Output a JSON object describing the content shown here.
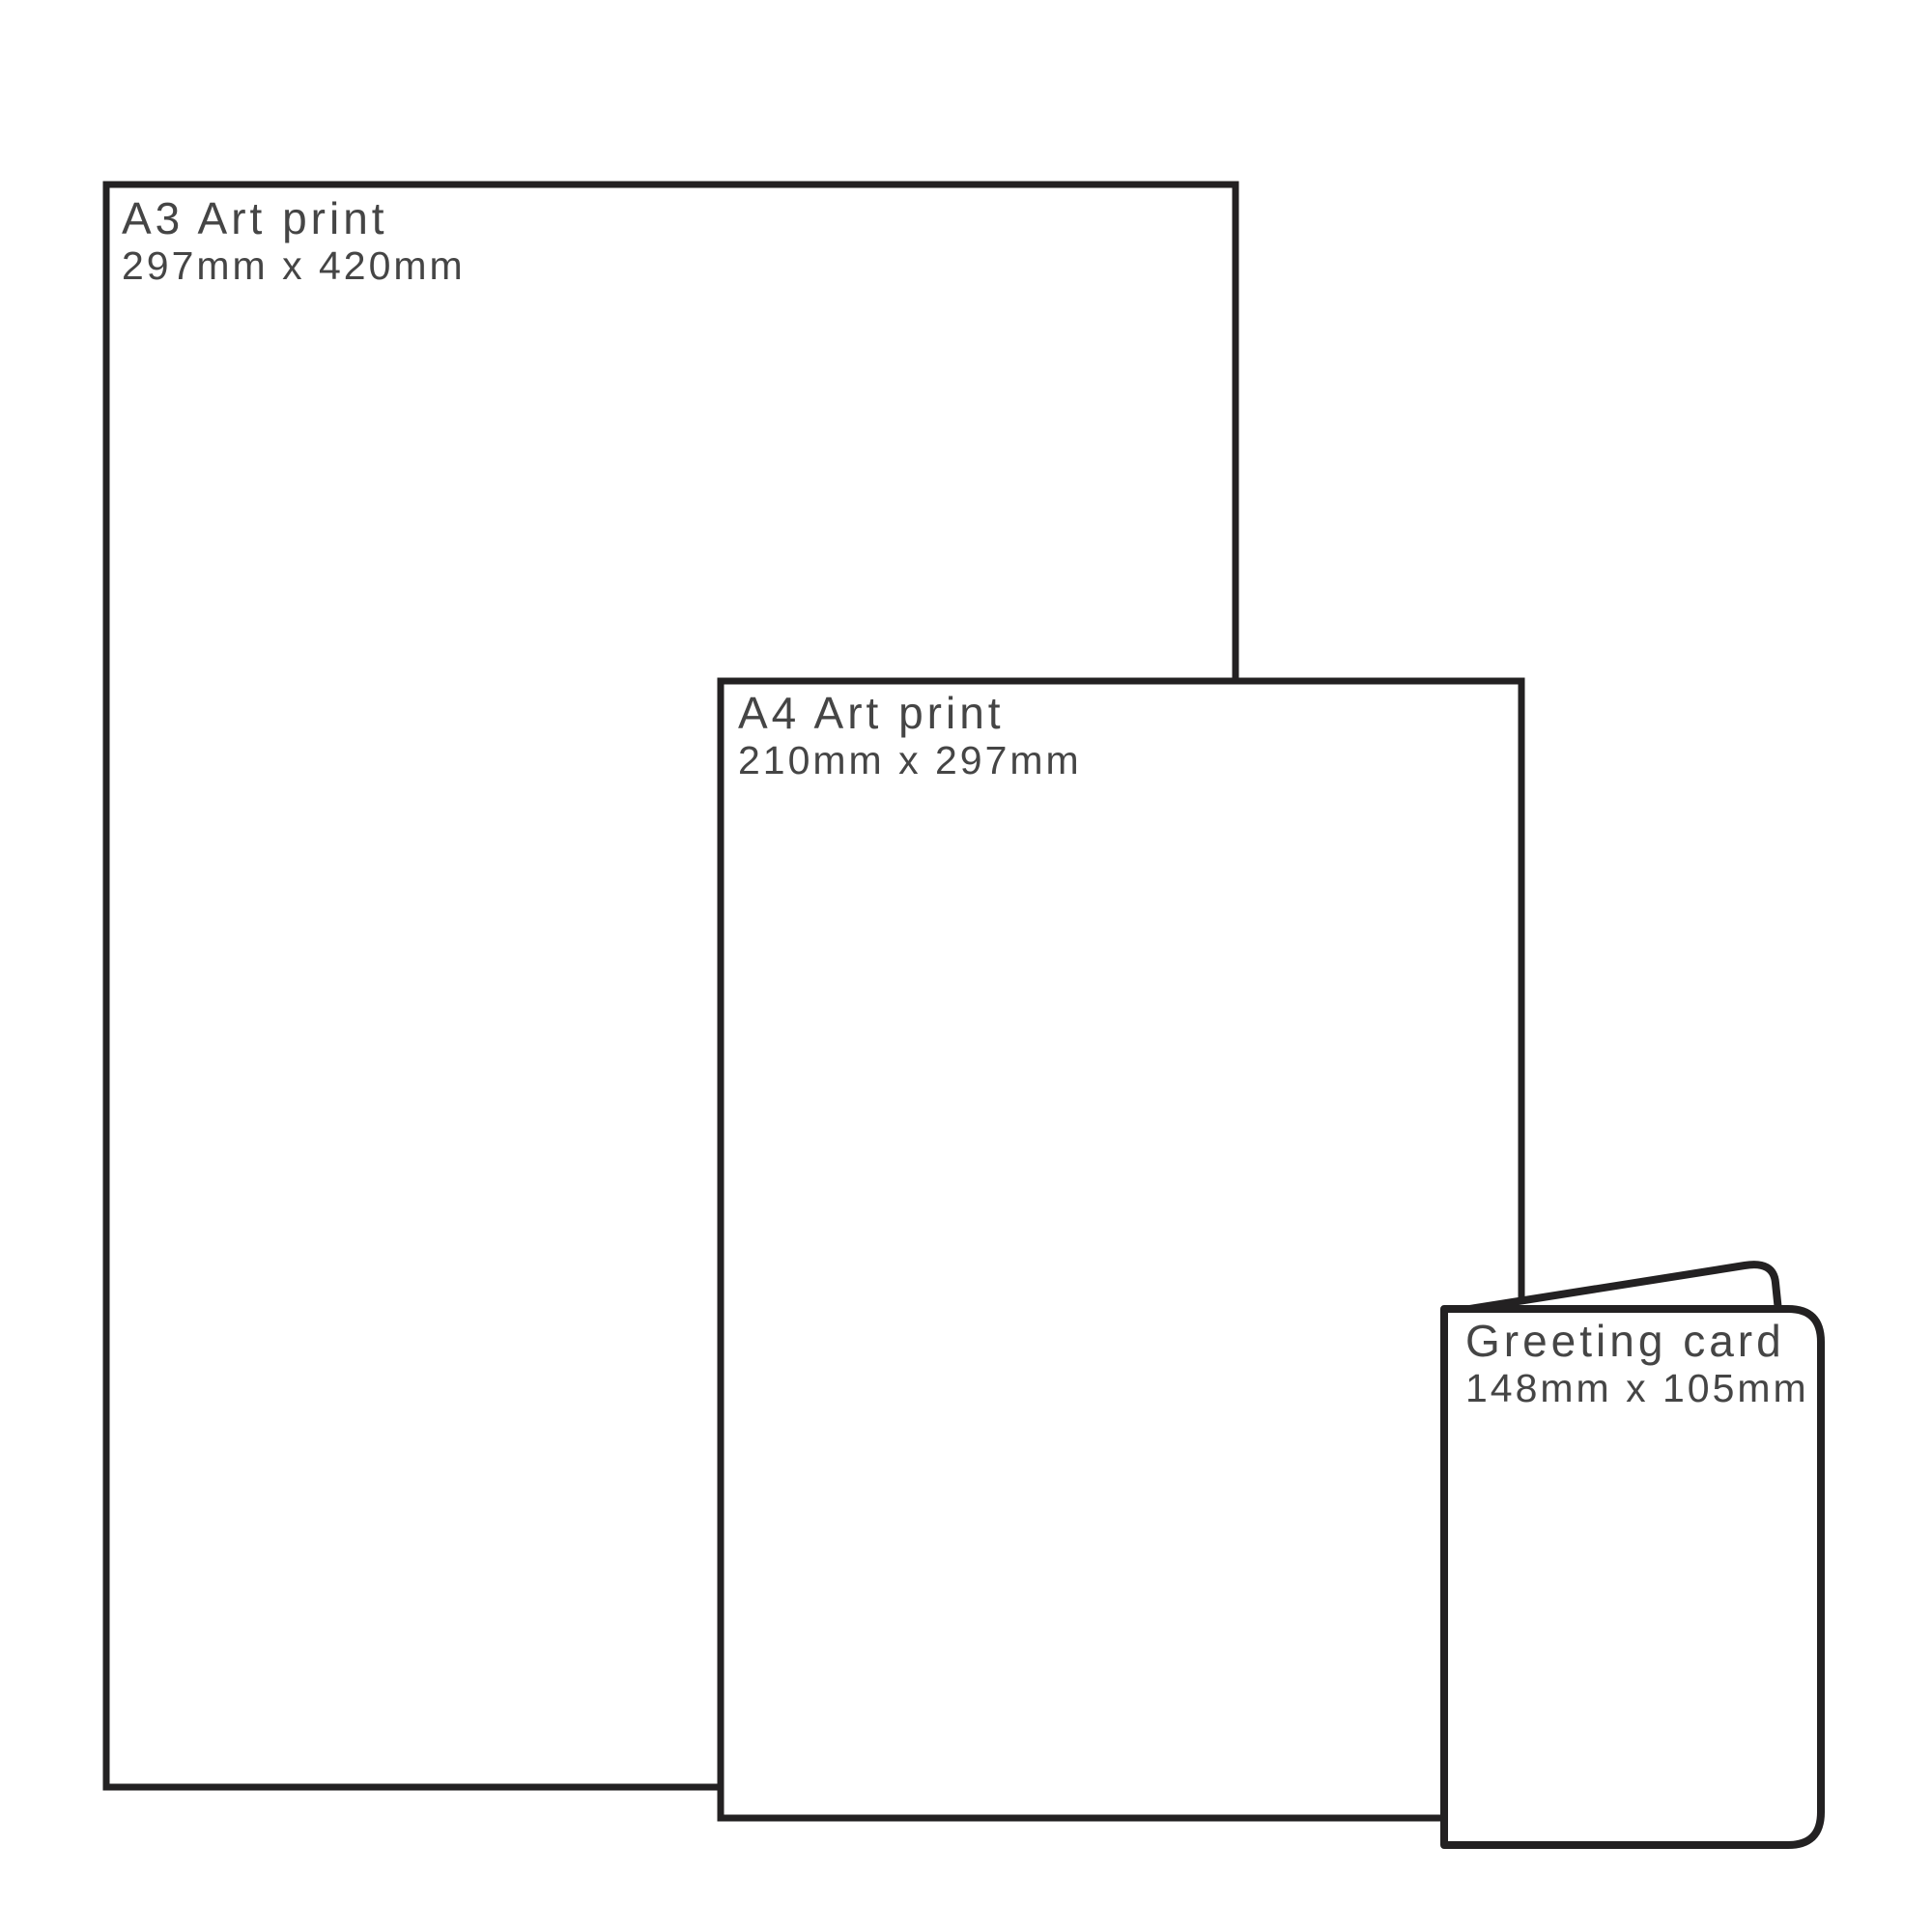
{
  "diagram": {
    "description": "Print size comparison diagram",
    "background_color": "#ffffff",
    "outline_color": "#232122",
    "text_color": "#454545",
    "panels": [
      {
        "title": "A3 Art print",
        "dimensions": "297mm x 420mm"
      },
      {
        "title": "A4 Art print",
        "dimensions": "210mm x 297mm"
      },
      {
        "title": "Greeting card",
        "dimensions": "148mm x 105mm"
      }
    ]
  }
}
